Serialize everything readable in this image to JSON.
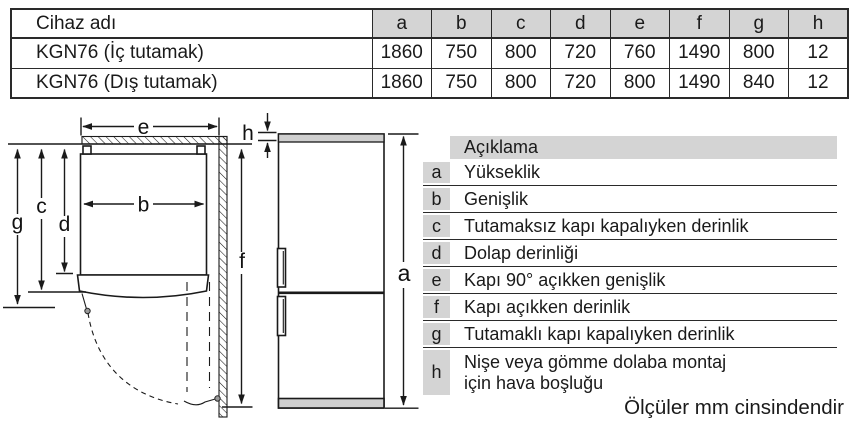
{
  "dims_table": {
    "name_header": "Cihaz adı",
    "col_headers": [
      "a",
      "b",
      "c",
      "d",
      "e",
      "f",
      "g",
      "h"
    ],
    "rows": [
      {
        "name": "KGN76 (İç tutamak)",
        "values": [
          "1860",
          "750",
          "800",
          "720",
          "760",
          "1490",
          "800",
          "12"
        ]
      },
      {
        "name": "KGN76 (Dış tutamak)",
        "values": [
          "1860",
          "750",
          "800",
          "720",
          "800",
          "1490",
          "840",
          "12"
        ]
      }
    ]
  },
  "legend": {
    "header": "Açıklama",
    "items": [
      {
        "key": "a",
        "label": "Yükseklik"
      },
      {
        "key": "b",
        "label": "Genişlik"
      },
      {
        "key": "c",
        "label": "Tutamaksız kapı kapalıyken derinlik"
      },
      {
        "key": "d",
        "label": "Dolap derinliği"
      },
      {
        "key": "e",
        "label": "Kapı 90° açıkken genişlik"
      },
      {
        "key": "f",
        "label": "Kapı açıkken derinlik"
      },
      {
        "key": "g",
        "label": "Tutamaklı kapı kapalıyken derinlik"
      },
      {
        "key": "h",
        "label": "Nişe veya gömme dolaba montaj",
        "label_line2": "için hava boşluğu"
      }
    ]
  },
  "diagram": {
    "labels": {
      "a": "a",
      "b": "b",
      "c": "c",
      "d": "d",
      "e": "e",
      "f": "f",
      "g": "g",
      "h": "h"
    }
  },
  "caption": "Ölçüler mm cinsindendir",
  "colors": {
    "table_header_bg": "#d4d4d4",
    "legend_key_bg": "#d4d4d4",
    "fridge_strip": "#cfcfcf",
    "line": "#1a1a1a"
  }
}
